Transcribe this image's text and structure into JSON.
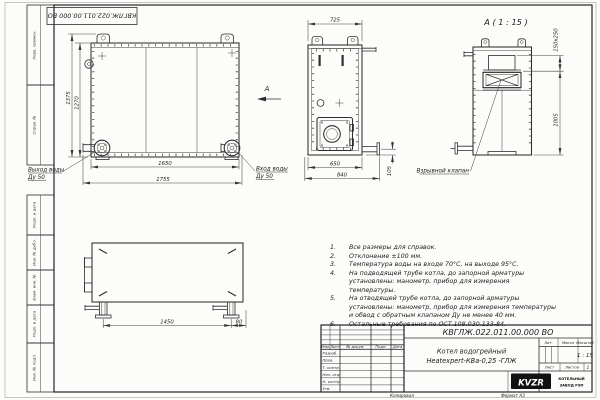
{
  "doc": {
    "number": "КВГЛЖ.022.011.00.000 ВО",
    "product_name_line1": "Котел водогрейный",
    "product_name_line2": "Heatexpert-КВа-0,25 -ГЛЖ"
  },
  "margin_stamps": [
    "Перв. примен.",
    "Справ. №",
    "Подп. и дата",
    "Инв. № дубл.",
    "Взам. инв. №",
    "Подп. и дата",
    "Инв. № подл."
  ],
  "views": {
    "front": {
      "dims": {
        "height_total": "1375",
        "height_body": "1270",
        "width_body": "1650",
        "width_total": "1755"
      },
      "outlet": {
        "line1": "Выход воды",
        "line2": "Ду 50"
      },
      "inlet": {
        "line1": "Вход воды",
        "line2": "Ду 50"
      },
      "arrow_label": "А"
    },
    "side": {
      "dims": {
        "top": "725",
        "bottom_inner": "650",
        "bottom_outer": "840",
        "pipe_height": "105"
      }
    },
    "detail": {
      "label": "А ( 1 : 15 )",
      "dims": {
        "valve": "150х250",
        "height": "1005"
      },
      "callout": "Взрывной клапан"
    },
    "plan": {
      "dims": {
        "legs_span": "1450",
        "offset": "80"
      }
    }
  },
  "notes": [
    {
      "num": "1.",
      "text": "Все размеры для справок."
    },
    {
      "num": "2.",
      "text": "Отклонение ±100 мм."
    },
    {
      "num": "3.",
      "text": "Температура воды на входе 70°С, на выходе 95°С."
    },
    {
      "num": "4.",
      "text": "На подводящей трубе котла, до запорной арматуры установлены: манометр, прибор для измерения температуры."
    },
    {
      "num": "5.",
      "text": "На отводящей трубе котла, до запорной арматуры установлены: манометр, прибор для измерения температуры и обвод с обратным клапаном Ду не менее 40 мм."
    },
    {
      "num": "6.",
      "text": "Остальные требования по ОСТ 108.030.133-84."
    }
  ],
  "title_block": {
    "cols": [
      "Изм.",
      "Лист",
      "№ докум.",
      "Подп.",
      "Дата"
    ],
    "rows": [
      "Разраб.",
      "Пров.",
      "Т. контр.",
      "Нач. отд.",
      "Н. контр.",
      "Утв."
    ],
    "lit_label": "Лит.",
    "mass_label": "Масса",
    "scale_label": "Масштаб",
    "scale_value": "1 : 15",
    "sheet_label": "Лист",
    "sheets_label": "Листов",
    "sheets_value": "1",
    "logo": "KVZR",
    "org_line1": "КОТЕЛЬНЫЙ",
    "org_line2": "ЗАВОД РЭП",
    "copied": "Копировал",
    "format": "Формат А3"
  }
}
